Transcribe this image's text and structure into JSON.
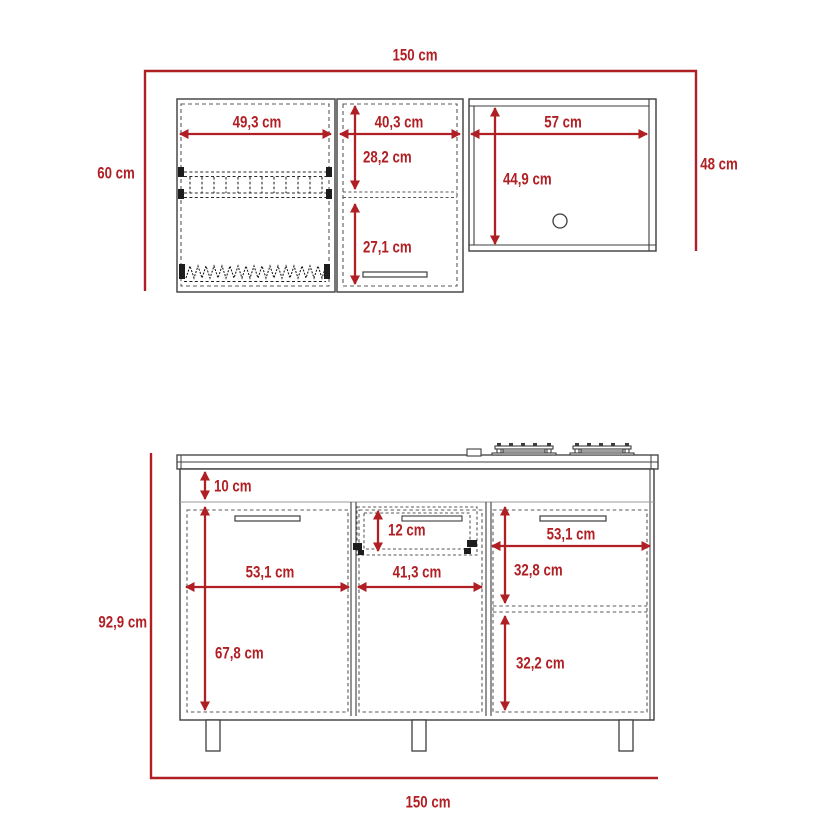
{
  "diagram_title": "kitchen cabinet set dimension drawing",
  "units": "cm",
  "colors": {
    "accent_red": "#b01f24",
    "line": "#3d3d3d",
    "dashed": "#5a5a5a"
  },
  "upper": {
    "total_width": "150 cm",
    "left_height": "60 cm",
    "right_height": "48 cm",
    "left_cab_width": "49,3 cm",
    "mid_cab_width": "40,3 cm",
    "mid_upper_door": "28,2 cm",
    "mid_lower_door": "27,1 cm",
    "right_cab_width": "57 cm",
    "right_interior_height": "44,9 cm"
  },
  "lower": {
    "total_width": "150 cm",
    "total_height": "92,9 cm",
    "apron": "10 cm",
    "drawer": "12 cm",
    "left_door_width": "53,1 cm",
    "mid_door_width": "41,3 cm",
    "right_door_width": "53,1 cm",
    "left_door_height": "67,8 cm",
    "right_upper": "32,8 cm",
    "right_lower": "32,2 cm"
  }
}
